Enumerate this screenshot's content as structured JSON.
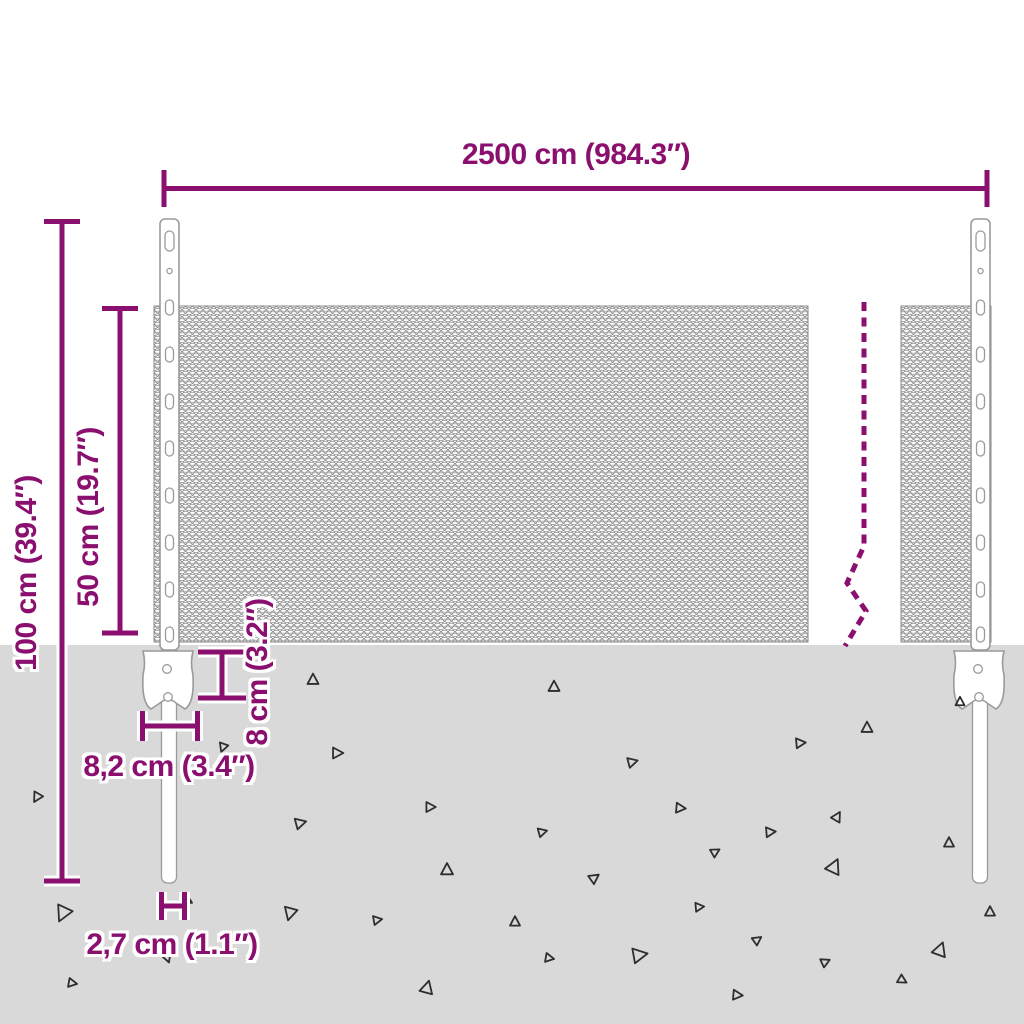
{
  "labels": {
    "total_width": "2500 cm (984.3″)",
    "total_height": "100 cm (39.4″)",
    "mesh_height": "50 cm (19.7″)",
    "anchor_height": "8 cm (3.2″)",
    "anchor_width": "8,2 cm (3.4″)",
    "post_width": "2,7 cm (1.1″)"
  },
  "colors": {
    "accent": "#8a0f6e",
    "ground": "#d9d9d9",
    "mesh_stroke": "#7d7d7d",
    "post_stroke": "#9a9a9a",
    "triangle_stroke": "#2e2e2e"
  },
  "ground": {
    "triangles": [
      [
        313,
        680,
        11,
        0
      ],
      [
        223,
        747,
        9,
        200
      ],
      [
        337,
        753,
        11,
        90
      ],
      [
        37,
        797,
        10,
        210
      ],
      [
        430,
        807,
        10,
        90
      ],
      [
        300,
        823,
        11,
        75
      ],
      [
        447,
        870,
        12,
        0
      ],
      [
        63,
        913,
        16,
        205
      ],
      [
        187,
        900,
        10,
        120
      ],
      [
        290,
        913,
        13,
        195
      ],
      [
        377,
        920,
        9,
        80
      ],
      [
        167,
        957,
        10,
        160
      ],
      [
        72,
        983,
        9,
        100
      ],
      [
        427,
        988,
        13,
        15
      ],
      [
        554,
        687,
        11,
        0
      ],
      [
        960,
        702,
        9,
        0
      ],
      [
        867,
        728,
        11,
        0
      ],
      [
        800,
        743,
        10,
        85
      ],
      [
        632,
        762,
        10,
        75
      ],
      [
        680,
        808,
        10,
        95
      ],
      [
        837,
        817,
        10,
        30
      ],
      [
        542,
        832,
        9,
        75
      ],
      [
        770,
        832,
        10,
        85
      ],
      [
        715,
        852,
        9,
        60
      ],
      [
        949,
        843,
        10,
        0
      ],
      [
        594,
        878,
        10,
        55
      ],
      [
        834,
        867,
        15,
        25
      ],
      [
        699,
        907,
        9,
        85
      ],
      [
        515,
        922,
        10,
        0
      ],
      [
        757,
        940,
        9,
        55
      ],
      [
        990,
        912,
        10,
        0
      ],
      [
        549,
        958,
        9,
        100
      ],
      [
        639,
        955,
        15,
        80
      ],
      [
        825,
        962,
        9,
        65
      ],
      [
        940,
        950,
        14,
        20
      ],
      [
        902,
        980,
        9,
        120
      ],
      [
        737,
        995,
        10,
        95
      ]
    ]
  }
}
